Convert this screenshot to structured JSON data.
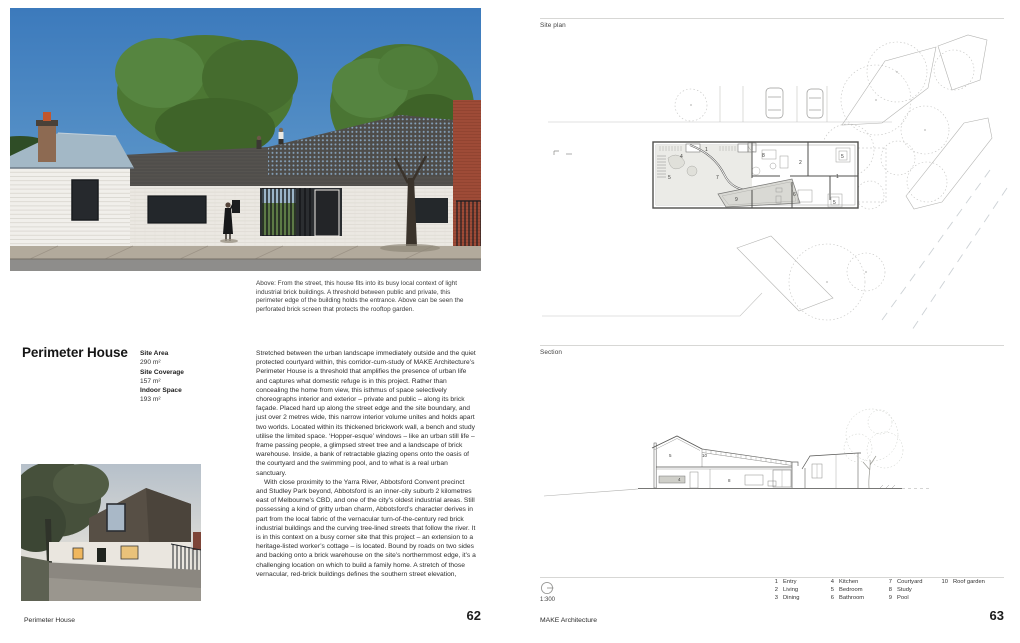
{
  "left_page": {
    "photo_caption": "Above: From the street, this house fits into its busy local context of light industrial brick buildings. A threshold between public and private, this perimeter edge of the building holds the entrance. Above can be seen the perforated brick screen that protects the rooftop garden.",
    "title": "Perimeter House",
    "stats": [
      {
        "label": "Site Area",
        "value": "290 m²"
      },
      {
        "label": "Site Coverage",
        "value": "157 m²"
      },
      {
        "label": "Indoor Space",
        "value": "193 m²"
      }
    ],
    "body_paragraph_1": "Stretched between the urban landscape immediately outside and the quiet protected courtyard within, this corridor-cum-study of MAKE Architecture’s Perimeter House is a threshold that amplifies the presence of urban life and captures what domestic refuge is in this project. Rather than concealing the home from view, this isthmus of space selectively choreographs interior and exterior – private and public – along its brick façade. Placed hard up along the street edge and the site boundary, and just over 2 metres wide, this narrow interior volume unites and holds apart two worlds. Located within its thickened brickwork wall, a bench and study utilise the limited space. ‘Hopper-esque’ windows – like an urban still life – frame passing people, a glimpsed street tree and a landscape of brick warehouse. Inside, a bank of retractable glazing opens onto the oasis of the courtyard and the swimming pool, and to what is a real urban sanctuary.",
    "body_paragraph_2": "With close proximity to the Yarra River, Abbotsford Convent precinct and Studley Park beyond, Abbotsford is an inner-city suburb 2 kilometres east of Melbourne’s CBD, and one of the city’s oldest industrial areas. Still possessing a kind of gritty urban charm, Abbotsford’s character derives in part from the local fabric of the vernacular turn-of-the-century red brick industrial buildings and the curving tree-lined streets that follow the river. It is in this context on a busy corner site that this project – an extension to a heritage-listed worker’s cottage – is located. Bound by roads on two sides and backing onto a brick warehouse on the site’s northernmost edge, it’s a challenging location on which to build a family home. A stretch of those vernacular, red-brick buildings defines the southern street elevation,",
    "footer_text": "Perimeter House",
    "page_number": "62"
  },
  "right_page": {
    "site_plan_label": "Site plan",
    "section_label": "Section",
    "scale_label": "1:300",
    "site_plan_numbers": [
      "1",
      "4",
      "8",
      "2",
      "5",
      "5",
      "7",
      "1",
      "9",
      "6",
      "5"
    ],
    "section_numbers": [
      "5",
      "10",
      "4",
      "8"
    ],
    "legend": {
      "columns": [
        {
          "items": [
            {
              "num": "1",
              "label": "Entry"
            },
            {
              "num": "2",
              "label": "Living"
            },
            {
              "num": "3",
              "label": "Dining"
            }
          ]
        },
        {
          "items": [
            {
              "num": "4",
              "label": "Kitchen"
            },
            {
              "num": "5",
              "label": "Bedroom"
            },
            {
              "num": "6",
              "label": "Bathroom"
            }
          ]
        },
        {
          "items": [
            {
              "num": "7",
              "label": "Courtyard"
            },
            {
              "num": "8",
              "label": "Study"
            },
            {
              "num": "9",
              "label": "Pool"
            }
          ]
        },
        {
          "items": [
            {
              "num": "10",
              "label": "Roof garden"
            }
          ]
        }
      ]
    },
    "footer_text": "MAKE Architecture",
    "page_number": "63"
  }
}
